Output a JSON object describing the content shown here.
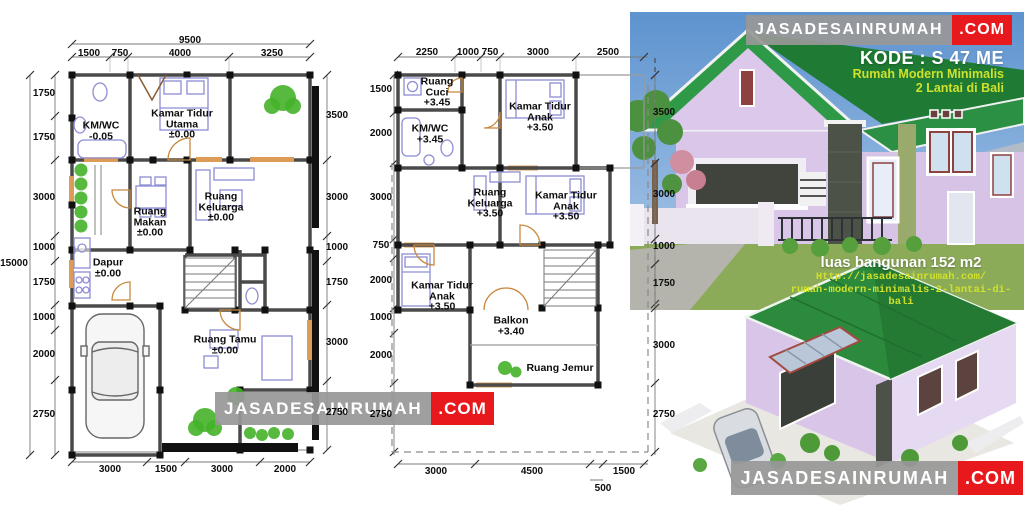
{
  "banner_top": {
    "brand": "JASADESAINRUMAH",
    "tld": ".COM"
  },
  "banner_center": {
    "brand": "JASADESAINRUMAH",
    "tld": ".COM"
  },
  "banner_bottom": {
    "brand": "JASADESAINRUMAH",
    "tld": ".COM"
  },
  "info": {
    "kode": "KODE : S 47 ME",
    "line1": "Rumah Modern Minimalis",
    "line2": "2 Lantai di Bali"
  },
  "overlay": {
    "area": "luas bangunan 152 m2",
    "url1": "Http://jasadesainrumah.com/",
    "url2": "rumah-modern-minimalis-2-lantai-di-bali"
  },
  "colors": {
    "accent_red": "#e8191d",
    "accent_yellow": "#cfe12c",
    "banner_gray": "#989898",
    "roof_green": "#2c8a3c",
    "wall_lavender": "#d9c6e8",
    "sky_blue": "#5d93cf"
  },
  "plan1": {
    "labels": [
      {
        "t": "total",
        "x": 190,
        "y": 41,
        "lines": [
          "9500"
        ]
      },
      {
        "t": "dim",
        "x": 89,
        "y": 54,
        "lines": [
          "1500"
        ]
      },
      {
        "t": "dim",
        "x": 120,
        "y": 54,
        "lines": [
          "750"
        ]
      },
      {
        "t": "dim",
        "x": 180,
        "y": 54,
        "lines": [
          "4000"
        ]
      },
      {
        "t": "dim",
        "x": 272,
        "y": 54,
        "lines": [
          "3250"
        ]
      },
      {
        "t": "total",
        "x": 14,
        "y": 264,
        "lines": [
          "15000"
        ]
      },
      {
        "t": "dim",
        "x": 44,
        "y": 94,
        "lines": [
          "1750"
        ]
      },
      {
        "t": "dim",
        "x": 44,
        "y": 138,
        "lines": [
          "1750"
        ]
      },
      {
        "t": "dim",
        "x": 44,
        "y": 198,
        "lines": [
          "3000"
        ]
      },
      {
        "t": "dim",
        "x": 44,
        "y": 248,
        "lines": [
          "1000"
        ]
      },
      {
        "t": "dim",
        "x": 44,
        "y": 283,
        "lines": [
          "1750"
        ]
      },
      {
        "t": "dim",
        "x": 44,
        "y": 318,
        "lines": [
          "1000"
        ]
      },
      {
        "t": "dim",
        "x": 44,
        "y": 355,
        "lines": [
          "2000"
        ]
      },
      {
        "t": "dim",
        "x": 44,
        "y": 415,
        "lines": [
          "2750"
        ]
      },
      {
        "t": "dim",
        "x": 337,
        "y": 116,
        "lines": [
          "3500"
        ]
      },
      {
        "t": "dim",
        "x": 337,
        "y": 198,
        "lines": [
          "3000"
        ]
      },
      {
        "t": "dim",
        "x": 337,
        "y": 248,
        "lines": [
          "1000"
        ]
      },
      {
        "t": "dim",
        "x": 337,
        "y": 283,
        "lines": [
          "1750"
        ]
      },
      {
        "t": "dim",
        "x": 337,
        "y": 343,
        "lines": [
          "3000"
        ]
      },
      {
        "t": "dim",
        "x": 337,
        "y": 413,
        "lines": [
          "2750"
        ]
      },
      {
        "t": "dim",
        "x": 110,
        "y": 470,
        "lines": [
          "3000"
        ]
      },
      {
        "t": "dim",
        "x": 166,
        "y": 470,
        "lines": [
          "1500"
        ]
      },
      {
        "t": "dim",
        "x": 222,
        "y": 470,
        "lines": [
          "3000"
        ]
      },
      {
        "t": "dim",
        "x": 285,
        "y": 470,
        "lines": [
          "2000"
        ]
      },
      {
        "t": "room",
        "x": 101,
        "y": 131,
        "lines": [
          "KM/WC",
          "-0.05"
        ]
      },
      {
        "t": "room",
        "x": 182,
        "y": 124,
        "lines": [
          "Kamar Tidur",
          "Utama",
          "±0.00"
        ]
      },
      {
        "t": "room",
        "x": 150,
        "y": 222,
        "lines": [
          "Ruang",
          "Makan",
          "±0.00"
        ]
      },
      {
        "t": "room",
        "x": 221,
        "y": 207,
        "lines": [
          "Ruang",
          "Keluarga",
          "±0.00"
        ]
      },
      {
        "t": "room",
        "x": 108,
        "y": 268,
        "lines": [
          "Dapur",
          "±0.00"
        ]
      },
      {
        "t": "room",
        "x": 225,
        "y": 345,
        "lines": [
          "Ruang Tamu",
          "±0.00"
        ]
      }
    ]
  },
  "plan2": {
    "labels": [
      {
        "t": "dim",
        "x": 427,
        "y": 53,
        "lines": [
          "2250"
        ]
      },
      {
        "t": "dim",
        "x": 468,
        "y": 53,
        "lines": [
          "1000"
        ]
      },
      {
        "t": "dim",
        "x": 490,
        "y": 53,
        "lines": [
          "750"
        ]
      },
      {
        "t": "dim",
        "x": 538,
        "y": 53,
        "lines": [
          "3000"
        ]
      },
      {
        "t": "dim",
        "x": 608,
        "y": 53,
        "lines": [
          "2500"
        ]
      },
      {
        "t": "dim",
        "x": 381,
        "y": 90,
        "lines": [
          "1500"
        ]
      },
      {
        "t": "dim",
        "x": 381,
        "y": 134,
        "lines": [
          "2000"
        ]
      },
      {
        "t": "dim",
        "x": 381,
        "y": 198,
        "lines": [
          "3000"
        ]
      },
      {
        "t": "dim",
        "x": 381,
        "y": 246,
        "lines": [
          "750"
        ]
      },
      {
        "t": "dim",
        "x": 381,
        "y": 281,
        "lines": [
          "2000"
        ]
      },
      {
        "t": "dim",
        "x": 381,
        "y": 318,
        "lines": [
          "1000"
        ]
      },
      {
        "t": "dim",
        "x": 381,
        "y": 356,
        "lines": [
          "2000"
        ]
      },
      {
        "t": "dim",
        "x": 381,
        "y": 415,
        "lines": [
          "2750"
        ]
      },
      {
        "t": "dim",
        "x": 664,
        "y": 113,
        "lines": [
          "3500"
        ]
      },
      {
        "t": "dim",
        "x": 664,
        "y": 195,
        "lines": [
          "3000"
        ]
      },
      {
        "t": "dim",
        "x": 664,
        "y": 247,
        "lines": [
          "1000"
        ]
      },
      {
        "t": "dim",
        "x": 664,
        "y": 284,
        "lines": [
          "1750"
        ]
      },
      {
        "t": "dim",
        "x": 664,
        "y": 346,
        "lines": [
          "3000"
        ]
      },
      {
        "t": "dim",
        "x": 664,
        "y": 415,
        "lines": [
          "2750"
        ]
      },
      {
        "t": "dim",
        "x": 436,
        "y": 472,
        "lines": [
          "3000"
        ]
      },
      {
        "t": "dim",
        "x": 532,
        "y": 472,
        "lines": [
          "4500"
        ]
      },
      {
        "t": "dim",
        "x": 624,
        "y": 472,
        "lines": [
          "1500"
        ]
      },
      {
        "t": "dim",
        "x": 603,
        "y": 489,
        "lines": [
          "500"
        ]
      },
      {
        "t": "room",
        "x": 437,
        "y": 92,
        "lines": [
          "Ruang",
          "Cuci",
          "+3.45"
        ]
      },
      {
        "t": "room",
        "x": 430,
        "y": 134,
        "lines": [
          "KM/WC",
          "+3.45"
        ]
      },
      {
        "t": "room",
        "x": 540,
        "y": 117,
        "lines": [
          "Kamar Tidur",
          "Anak",
          "+3.50"
        ]
      },
      {
        "t": "room",
        "x": 490,
        "y": 203,
        "lines": [
          "Ruang",
          "Keluarga",
          "+3.50"
        ]
      },
      {
        "t": "room",
        "x": 566,
        "y": 206,
        "lines": [
          "Kamar Tidur",
          "Anak",
          "+3.50"
        ]
      },
      {
        "t": "room",
        "x": 442,
        "y": 296,
        "lines": [
          "Kamar Tidur",
          "Anak",
          "+3.50"
        ]
      },
      {
        "t": "room",
        "x": 511,
        "y": 326,
        "lines": [
          "Balkon",
          "+3.40"
        ]
      },
      {
        "t": "room",
        "x": 560,
        "y": 368,
        "lines": [
          "Ruang Jemur"
        ]
      }
    ]
  }
}
